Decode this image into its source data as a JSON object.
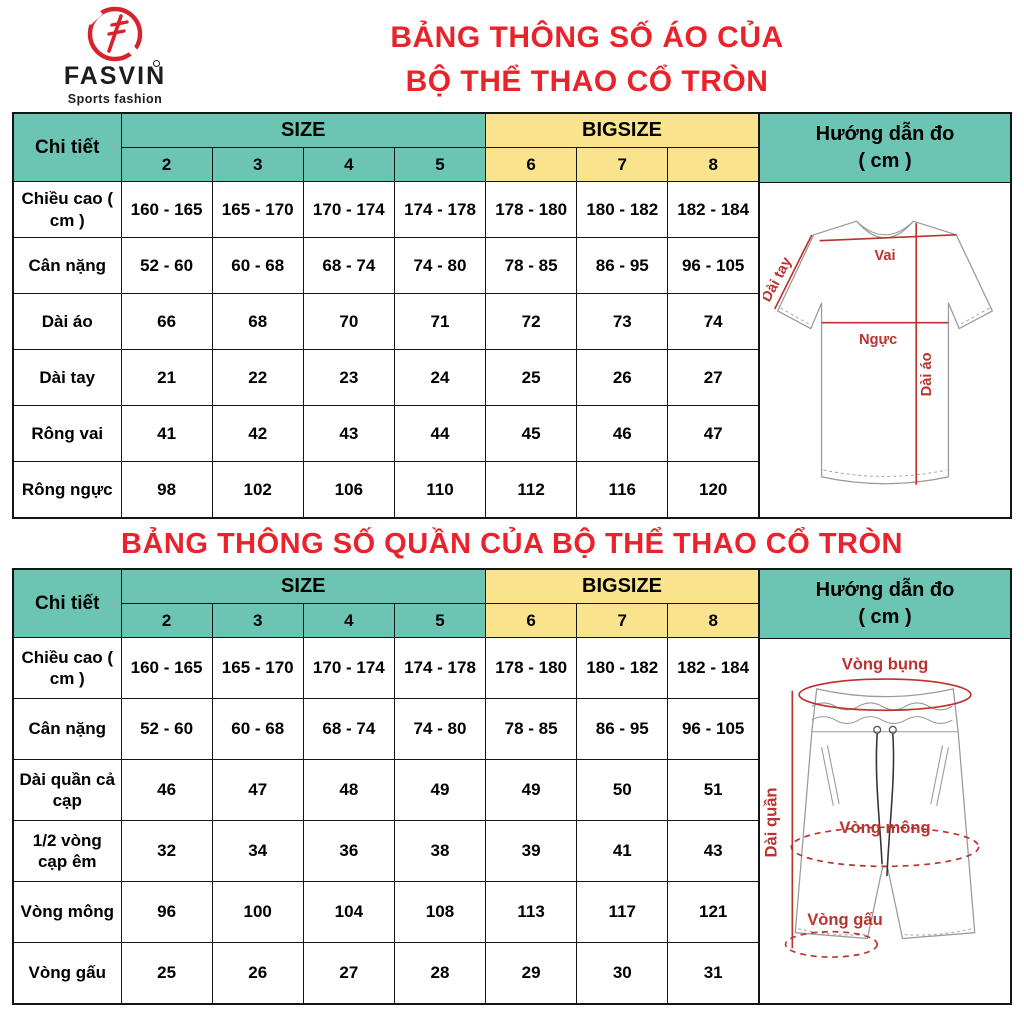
{
  "brand": {
    "name": "FASVIN",
    "tagline": "Sports fashion"
  },
  "colors": {
    "teal": "#6cc5b2",
    "yellow": "#f9e48d",
    "title_red": "#e8232b",
    "diagram_red": "#bb322e"
  },
  "shirt": {
    "title_line1": "BẢNG THÔNG SỐ ÁO CỦA",
    "title_line2": "BỘ THỂ THAO CỔ TRÒN",
    "table": {
      "detail_header": "Chi tiết",
      "size_header": "SIZE",
      "bigsize_header": "BIGSIZE",
      "guide_header_line1": "Hướng dẫn đo",
      "guide_header_line2": "( cm )",
      "size_cols": [
        "2",
        "3",
        "4",
        "5"
      ],
      "bigsize_cols": [
        "6",
        "7",
        "8"
      ],
      "rows": [
        {
          "label": "Chiều cao ( cm )",
          "values": [
            "160 - 165",
            "165 - 170",
            "170 - 174",
            "174 - 178",
            "178 - 180",
            "180 - 182",
            "182 - 184"
          ]
        },
        {
          "label": "Cân nặng",
          "values": [
            "52 - 60",
            "60 - 68",
            "68 - 74",
            "74 - 80",
            "78 - 85",
            "86 - 95",
            "96 - 105"
          ]
        },
        {
          "label": "Dài áo",
          "values": [
            "66",
            "68",
            "70",
            "71",
            "72",
            "73",
            "74"
          ]
        },
        {
          "label": "Dài tay",
          "values": [
            "21",
            "22",
            "23",
            "24",
            "25",
            "26",
            "27"
          ]
        },
        {
          "label": "Rông vai",
          "values": [
            "41",
            "42",
            "43",
            "44",
            "45",
            "46",
            "47"
          ]
        },
        {
          "label": "Rông ngực",
          "values": [
            "98",
            "102",
            "106",
            "110",
            "112",
            "116",
            "120"
          ]
        }
      ]
    },
    "diagram": {
      "vai": "Vai",
      "nguc": "Ngực",
      "dai_ao": "Dài áo",
      "dai_tay": "Dài tay"
    }
  },
  "pants": {
    "title": "BẢNG THÔNG SỐ QUẦN CỦA BỘ THỂ THAO CỔ TRÒN",
    "table": {
      "detail_header": "Chi tiết",
      "size_header": "SIZE",
      "bigsize_header": "BIGSIZE",
      "guide_header_line1": "Hướng dẫn đo",
      "guide_header_line2": "( cm )",
      "size_cols": [
        "2",
        "3",
        "4",
        "5"
      ],
      "bigsize_cols": [
        "6",
        "7",
        "8"
      ],
      "rows": [
        {
          "label": "Chiều cao ( cm )",
          "values": [
            "160 - 165",
            "165 - 170",
            "170 - 174",
            "174 - 178",
            "178 - 180",
            "180 - 182",
            "182 - 184"
          ]
        },
        {
          "label": "Cân nặng",
          "values": [
            "52 - 60",
            "60 - 68",
            "68 - 74",
            "74 - 80",
            "78 - 85",
            "86 - 95",
            "96 - 105"
          ]
        },
        {
          "label": "Dài quần cả cạp",
          "values": [
            "46",
            "47",
            "48",
            "49",
            "49",
            "50",
            "51"
          ]
        },
        {
          "label": "1/2 vòng cạp êm",
          "values": [
            "32",
            "34",
            "36",
            "38",
            "39",
            "41",
            "43"
          ]
        },
        {
          "label": "Vòng mông",
          "values": [
            "96",
            "100",
            "104",
            "108",
            "113",
            "117",
            "121"
          ]
        },
        {
          "label": "Vòng gấu",
          "values": [
            "25",
            "26",
            "27",
            "28",
            "29",
            "30",
            "31"
          ]
        }
      ]
    },
    "diagram": {
      "vong_bung": "Vòng bụng",
      "vong_mong": "Vòng mông",
      "vong_gau": "Vòng gấu",
      "dai_quan": "Dài quần"
    }
  }
}
